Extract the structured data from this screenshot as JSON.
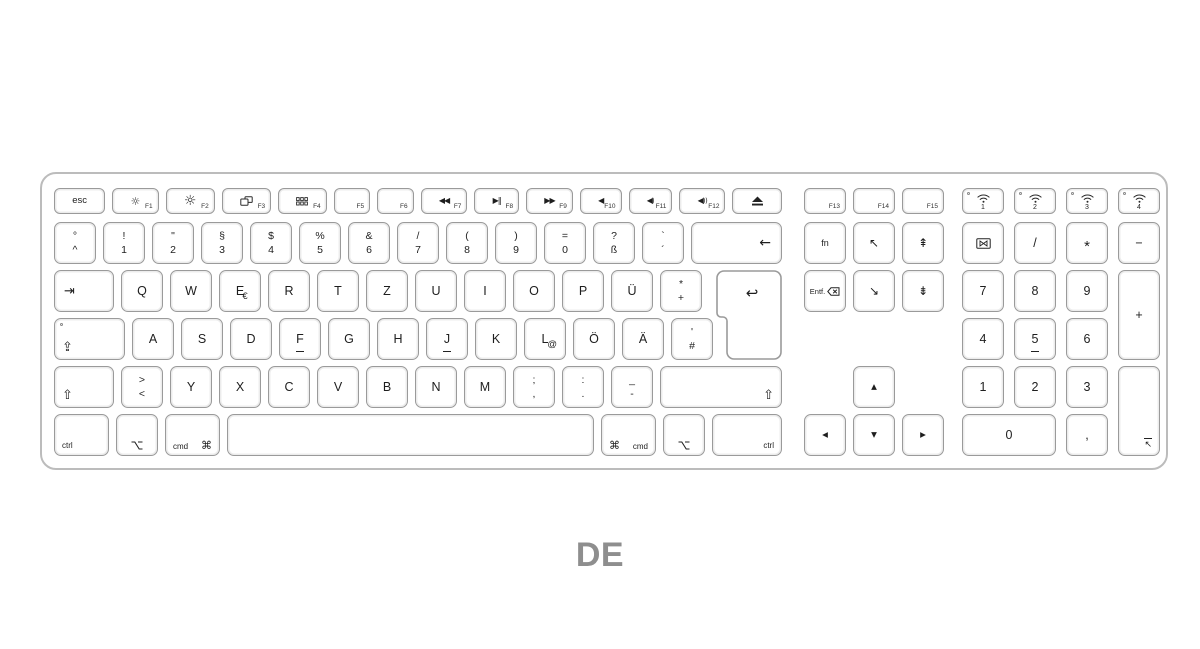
{
  "page": {
    "label": "DE"
  },
  "colors": {
    "key_border": "#9a9a9a",
    "key_inner_ring": "#ececec",
    "shell_border": "#bcbcbc",
    "legend": "#1e1e1e",
    "layout_label_gray": "#8e8e8e"
  },
  "function_row": {
    "main": [
      {
        "name": "esc",
        "center": "esc",
        "cls": "esckey"
      },
      {
        "name": "f1",
        "icon": "brightness-low",
        "flabel": "F1"
      },
      {
        "name": "f2",
        "icon": "brightness-high",
        "flabel": "F2"
      },
      {
        "name": "f3",
        "icon": "mission-control",
        "flabel": "F3"
      },
      {
        "name": "f4",
        "icon": "launchpad",
        "flabel": "F4"
      },
      {
        "name": "f5",
        "flabel": "F5"
      },
      {
        "name": "f6",
        "flabel": "F6"
      },
      {
        "name": "f7",
        "icon": "rewind",
        "flabel": "F7"
      },
      {
        "name": "f8",
        "icon": "play-pause",
        "flabel": "F8"
      },
      {
        "name": "f9",
        "icon": "fast-forward",
        "flabel": "F9"
      },
      {
        "name": "f10",
        "icon": "mute",
        "flabel": "F10"
      },
      {
        "name": "f11",
        "icon": "volume-down",
        "flabel": "F11"
      },
      {
        "name": "f12",
        "icon": "volume-up",
        "flabel": "F12"
      },
      {
        "name": "eject",
        "icon": "eject"
      }
    ],
    "nav": [
      {
        "name": "f13",
        "flabel": "F13"
      },
      {
        "name": "f14",
        "flabel": "F14"
      },
      {
        "name": "f15",
        "flabel": "F15"
      }
    ],
    "pad": [
      {
        "name": "wireless-1",
        "icon": "wifi",
        "num": "1",
        "led": true,
        "cls": "wkey"
      },
      {
        "name": "wireless-2",
        "icon": "wifi",
        "num": "2",
        "led": true,
        "cls": "wkey"
      },
      {
        "name": "wireless-3",
        "icon": "wifi",
        "num": "3",
        "led": true,
        "cls": "wkey"
      },
      {
        "name": "wireless-4",
        "icon": "wifi",
        "num": "4",
        "led": true,
        "cls": "wkey"
      }
    ]
  },
  "main_rows": [
    {
      "name": "number-row",
      "top": 48,
      "keys": [
        {
          "name": "circumflex",
          "t": "°",
          "b": "^",
          "w": 42
        },
        {
          "name": "1",
          "t": "!",
          "b": "1",
          "w": 42
        },
        {
          "name": "2",
          "t": "\"",
          "b": "2",
          "w": 42
        },
        {
          "name": "3",
          "t": "§",
          "b": "3",
          "w": 42
        },
        {
          "name": "4",
          "t": "$",
          "b": "4",
          "w": 42
        },
        {
          "name": "5",
          "t": "%",
          "b": "5",
          "w": 42
        },
        {
          "name": "6",
          "t": "&",
          "b": "6",
          "w": 42
        },
        {
          "name": "7",
          "t": "/",
          "b": "7",
          "w": 42
        },
        {
          "name": "8",
          "t": "(",
          "b": "8",
          "w": 42
        },
        {
          "name": "9",
          "t": ")",
          "b": "9",
          "w": 42
        },
        {
          "name": "0",
          "t": "=",
          "b": "0",
          "w": 42
        },
        {
          "name": "eszett",
          "t": "?",
          "b": "ß",
          "w": 42
        },
        {
          "name": "acute",
          "t": "`",
          "b": "´",
          "w": 42
        },
        {
          "name": "backspace",
          "icon": "backspace",
          "flex": true,
          "align": "r"
        }
      ]
    },
    {
      "name": "top-letter-row",
      "top": 96,
      "keys": [
        {
          "name": "tab",
          "icon": "tab",
          "w": 60,
          "align": "l"
        },
        {
          "name": "q",
          "center": "Q",
          "w": 42
        },
        {
          "name": "w",
          "center": "W",
          "w": 42
        },
        {
          "name": "e",
          "center": "E",
          "adj": "€",
          "w": 42
        },
        {
          "name": "r",
          "center": "R",
          "w": 42
        },
        {
          "name": "t",
          "center": "T",
          "w": 42
        },
        {
          "name": "z",
          "center": "Z",
          "w": 42
        },
        {
          "name": "u",
          "center": "U",
          "w": 42
        },
        {
          "name": "i",
          "center": "I",
          "w": 42
        },
        {
          "name": "o",
          "center": "O",
          "w": 42
        },
        {
          "name": "p",
          "center": "P",
          "w": 42
        },
        {
          "name": "u-umlaut",
          "center": "Ü",
          "w": 42
        },
        {
          "name": "plus",
          "t": "*",
          "b": "+",
          "w": 42
        }
      ]
    },
    {
      "name": "home-row",
      "top": 144,
      "keys": [
        {
          "name": "caps-lock",
          "icon": "caps",
          "led": true,
          "w": 71,
          "align": "bl"
        },
        {
          "name": "a",
          "center": "A",
          "w": 42
        },
        {
          "name": "s",
          "center": "S",
          "w": 42
        },
        {
          "name": "d",
          "center": "D",
          "w": 42
        },
        {
          "name": "f",
          "center": "F",
          "bar": true,
          "w": 42
        },
        {
          "name": "g",
          "center": "G",
          "w": 42
        },
        {
          "name": "h",
          "center": "H",
          "w": 42
        },
        {
          "name": "j",
          "center": "J",
          "bar": true,
          "w": 42
        },
        {
          "name": "k",
          "center": "K",
          "w": 42
        },
        {
          "name": "l",
          "center": "L",
          "adj": "@",
          "w": 42
        },
        {
          "name": "o-umlaut",
          "center": "Ö",
          "w": 42
        },
        {
          "name": "a-umlaut",
          "center": "Ä",
          "w": 42
        },
        {
          "name": "hash",
          "t": "'",
          "b": "#",
          "w": 42
        }
      ]
    },
    {
      "name": "bottom-letter-row",
      "top": 192,
      "keys": [
        {
          "name": "left-shift",
          "icon": "shift",
          "w": 60,
          "align": "bl"
        },
        {
          "name": "angle-bracket",
          "t": ">",
          "b": "<",
          "w": 42
        },
        {
          "name": "y",
          "center": "Y",
          "w": 42
        },
        {
          "name": "x",
          "center": "X",
          "w": 42
        },
        {
          "name": "c",
          "center": "C",
          "w": 42
        },
        {
          "name": "v",
          "center": "V",
          "w": 42
        },
        {
          "name": "b",
          "center": "B",
          "w": 42
        },
        {
          "name": "n",
          "center": "N",
          "w": 42
        },
        {
          "name": "m",
          "center": "M",
          "w": 42
        },
        {
          "name": "semicolon",
          "t": ";",
          "b": ",",
          "w": 42
        },
        {
          "name": "colon",
          "t": ":",
          "b": ".",
          "w": 42
        },
        {
          "name": "underscore",
          "t": "_",
          "b": "-",
          "w": 42
        },
        {
          "name": "right-shift",
          "icon": "shift",
          "flex": true,
          "align": "br"
        }
      ]
    },
    {
      "name": "modifier-row",
      "top": 240,
      "keys": [
        {
          "name": "left-ctrl",
          "text": "ctrl",
          "w": 55,
          "align": "bl"
        },
        {
          "name": "left-option",
          "icon": "option",
          "w": 42,
          "align": "bc"
        },
        {
          "name": "left-cmd",
          "text": "cmd",
          "icon": "cmd",
          "w": 55,
          "align": "spread"
        },
        {
          "name": "space",
          "flex": true
        },
        {
          "name": "right-cmd",
          "text": "cmd",
          "icon": "cmd",
          "iconfirst": true,
          "w": 55,
          "align": "spread"
        },
        {
          "name": "right-option",
          "icon": "option",
          "w": 42,
          "align": "bc"
        },
        {
          "name": "right-ctrl",
          "text": "ctrl",
          "w": 70,
          "align": "br"
        }
      ]
    }
  ],
  "return_key": {
    "name": "return",
    "icon": "return"
  },
  "nav_keys": [
    {
      "name": "fn",
      "center": "fn",
      "cls": "smalltext",
      "col": 1,
      "row": 1
    },
    {
      "name": "home",
      "icon": "home",
      "col": 2,
      "row": 1
    },
    {
      "name": "page-up",
      "icon": "page-up",
      "col": 3,
      "row": 1
    },
    {
      "name": "forward-delete",
      "text": "Entf.",
      "icon": "delete-forward",
      "cls": "entf",
      "align": "crow",
      "col": 1,
      "row": 2
    },
    {
      "name": "end",
      "icon": "end",
      "col": 2,
      "row": 2
    },
    {
      "name": "page-down",
      "icon": "page-down",
      "col": 3,
      "row": 2
    },
    {
      "name": "arrow-up",
      "icon": "arrow-up",
      "col": 2,
      "row": 4
    },
    {
      "name": "arrow-left",
      "icon": "arrow-left",
      "col": 1,
      "row": 5
    },
    {
      "name": "arrow-down",
      "icon": "arrow-down",
      "col": 2,
      "row": 5
    },
    {
      "name": "arrow-right",
      "icon": "arrow-right",
      "col": 3,
      "row": 5
    }
  ],
  "pad_keys": [
    {
      "name": "num-clear",
      "icon": "num-clear",
      "col": 1,
      "row": 1
    },
    {
      "name": "num-divide",
      "center": "/",
      "col": 2,
      "row": 1
    },
    {
      "name": "num-multiply",
      "center": "*",
      "cls": "star",
      "col": 3,
      "row": 1
    },
    {
      "name": "num-minus",
      "center": "−",
      "col": 4,
      "row": 1
    },
    {
      "name": "num-7",
      "center": "7",
      "col": 1,
      "row": 2
    },
    {
      "name": "num-8",
      "center": "8",
      "col": 2,
      "row": 2
    },
    {
      "name": "num-9",
      "center": "9",
      "col": 3,
      "row": 2
    },
    {
      "name": "num-plus",
      "center": "+",
      "col": 4,
      "row": 2,
      "rowspan": 2
    },
    {
      "name": "num-4",
      "center": "4",
      "col": 1,
      "row": 3
    },
    {
      "name": "num-5",
      "center": "5",
      "bar": true,
      "col": 2,
      "row": 3
    },
    {
      "name": "num-6",
      "center": "6",
      "col": 3,
      "row": 3
    },
    {
      "name": "num-1",
      "center": "1",
      "col": 1,
      "row": 4
    },
    {
      "name": "num-2",
      "center": "2",
      "col": 2,
      "row": 4
    },
    {
      "name": "num-3",
      "center": "3",
      "col": 3,
      "row": 4
    },
    {
      "name": "num-enter",
      "icon": "numpad-enter",
      "align": "br",
      "col": 4,
      "row": 4,
      "rowspan": 2
    },
    {
      "name": "num-0",
      "center": "0",
      "col": 1,
      "row": 5,
      "colspan": 2
    },
    {
      "name": "num-comma",
      "center": ",",
      "col": 3,
      "row": 5
    }
  ]
}
